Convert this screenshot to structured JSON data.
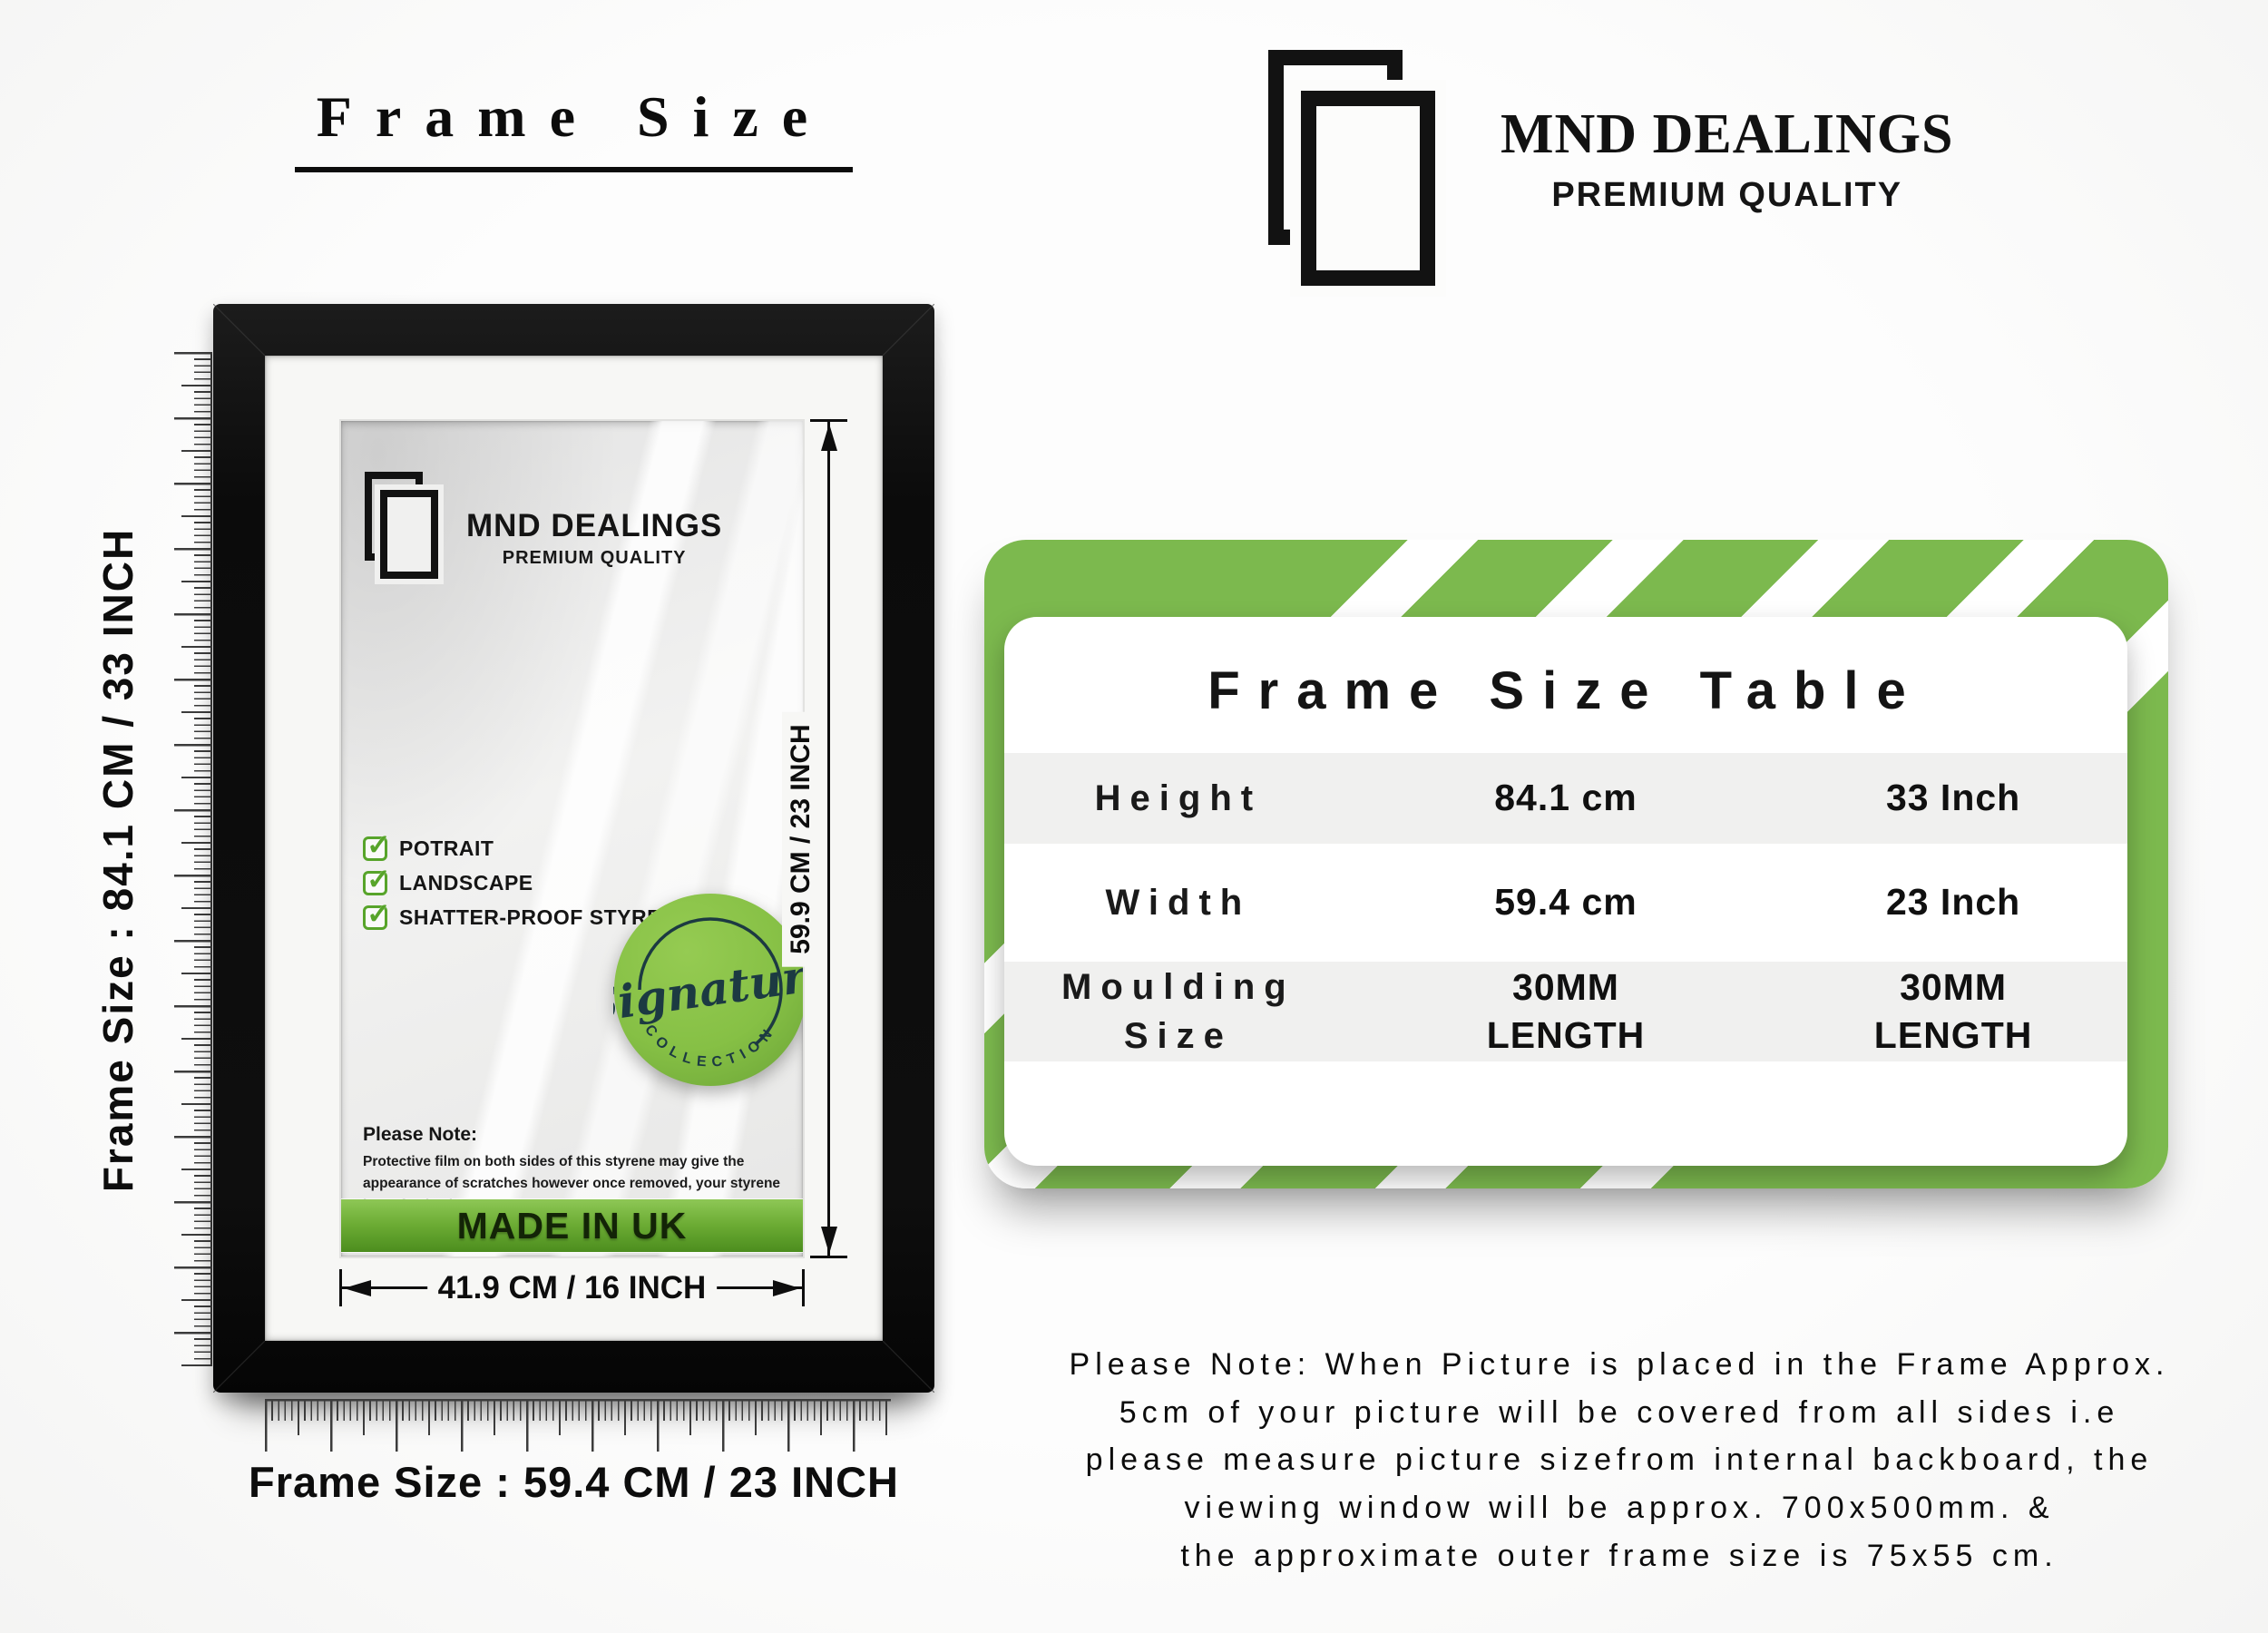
{
  "left": {
    "heading": "Frame Size",
    "vertical_ruler_label": "Frame Size : 84.1 CM / 33 INCH",
    "horizontal_ruler_label": "Frame Size : 59.4 CM / 23 INCH"
  },
  "frame": {
    "logo": {
      "name": "MND DEALINGS",
      "tagline": "PREMIUM QUALITY"
    },
    "features": [
      "POTRAIT",
      "LANDSCAPE",
      "SHATTER-PROOF STYRENE"
    ],
    "badge": {
      "word": "Signature",
      "arc": "COLLECTION"
    },
    "note": {
      "title": "Please Note:",
      "body": "Protective film on both sides of this styrene may give the appearance of scratches however once removed, your styrene is perfectly clear,"
    },
    "made_in": "MADE IN UK",
    "inner_width": "41.9 CM / 16 INCH",
    "inner_height": "59.9 CM / 23 INCH"
  },
  "brand": {
    "name": "MND DEALINGS",
    "tagline": "PREMIUM QUALITY"
  },
  "table": {
    "title": "Frame Size Table",
    "rows": [
      {
        "label": "Height",
        "metric": "84.1 cm",
        "imperial": "33 Inch"
      },
      {
        "label": "Width",
        "metric": "59.4 cm",
        "imperial": "23 Inch"
      },
      {
        "label": "Moulding Size",
        "metric": "30MM LENGTH",
        "imperial": "30MM LENGTH"
      }
    ]
  },
  "sizing_note": {
    "lines": [
      "Please Note: When Picture is placed in the Frame Approx.",
      "5cm of your picture will be covered from all sides i.e",
      "please measure picture sizefrom internal backboard, the",
      "viewing window will be approx. 700x500mm. &",
      "the approximate outer frame size is 75x55 cm."
    ]
  },
  "icons": {
    "check": "✓"
  },
  "colors": {
    "stripe_green": "#7cb94e",
    "banner_green": "#6cac34",
    "badge_green": "#86c045",
    "check_green": "#57a42a",
    "frame_black": "#0e0e0e",
    "row_gray": "#f0f0ef",
    "badge_text_dark": "#1c3a42"
  }
}
